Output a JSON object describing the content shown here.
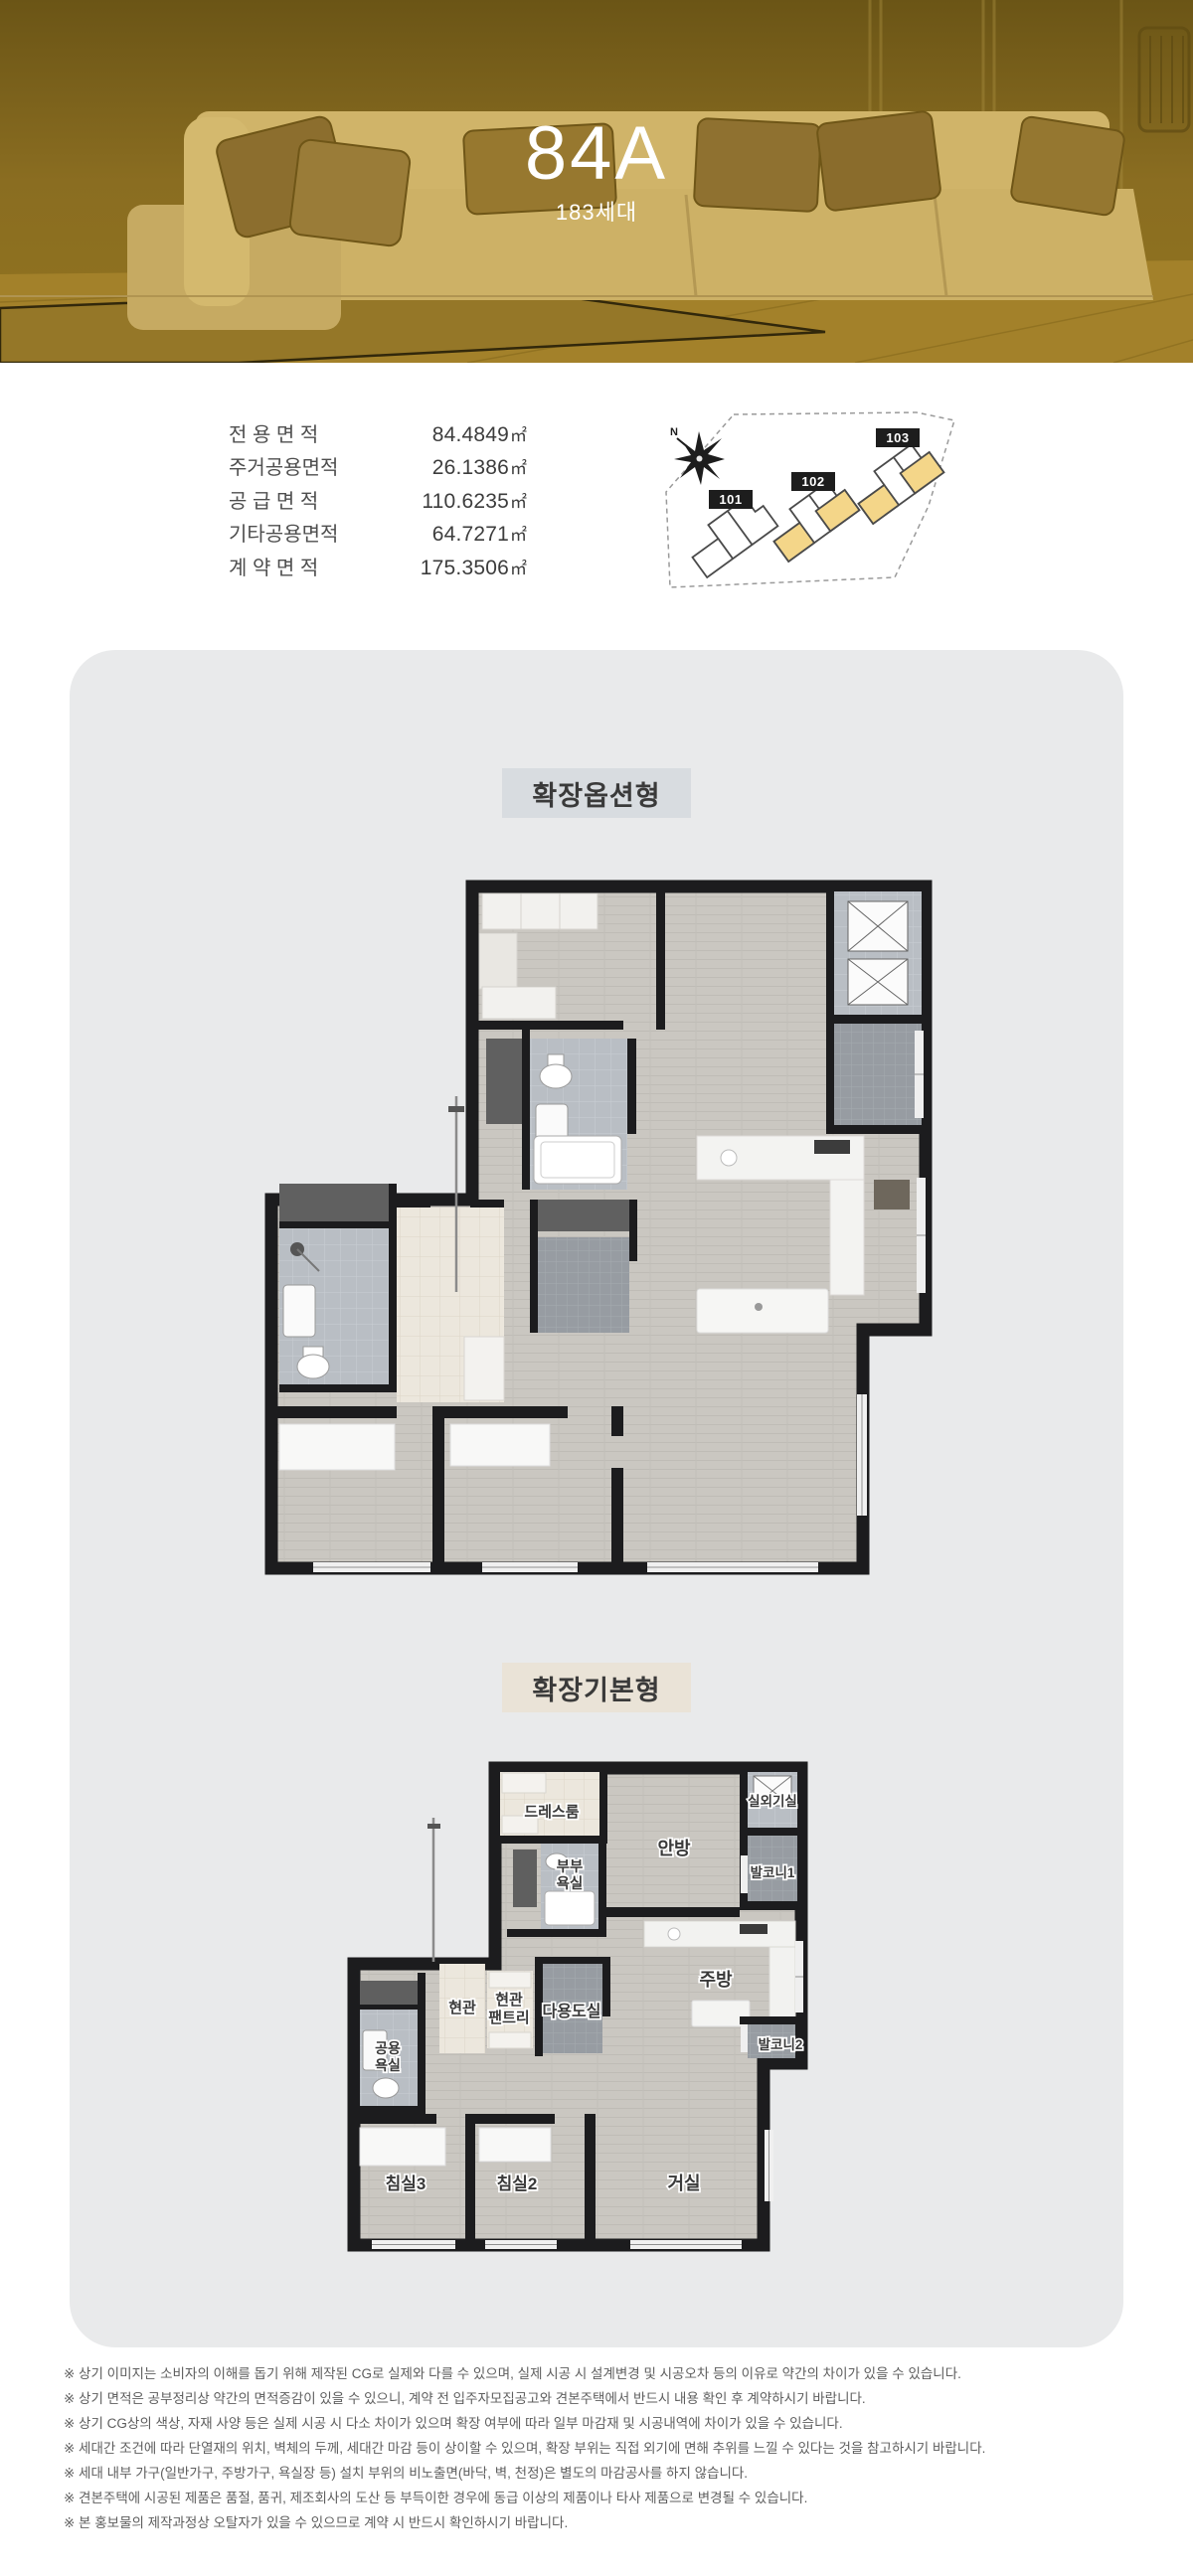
{
  "hero": {
    "title": "84A",
    "subtitle": "183세대"
  },
  "area_table": {
    "rows": [
      {
        "label": "전 용 면 적",
        "value": "84.4849",
        "unit": "㎡"
      },
      {
        "label": "주거공용면적",
        "value": "26.1386",
        "unit": "㎡"
      },
      {
        "label": "공 급 면 적",
        "value": "110.6235",
        "unit": "㎡"
      },
      {
        "label": "기타공용면적",
        "value": "64.7271",
        "unit": "㎡"
      },
      {
        "label": "계 약 면 적",
        "value": "175.3506",
        "unit": "㎡"
      }
    ]
  },
  "site_plan": {
    "north_label": "N",
    "highlight_color": "#f4d689",
    "buildings": [
      {
        "id": "101",
        "highlighted": false
      },
      {
        "id": "102",
        "highlighted": true
      },
      {
        "id": "103",
        "highlighted": true
      }
    ]
  },
  "sections": [
    {
      "label": "확장옵션형"
    },
    {
      "label": "확장기본형"
    }
  ],
  "rooms": {
    "dressroom": "드레스룸",
    "master": "안방",
    "outdoor_unit": "실외기실",
    "master_bath": {
      "line1": "부부",
      "line2": "욕실"
    },
    "balcony1": "발코니1",
    "kitchen": "주방",
    "entry": "현관",
    "entry_pantry": {
      "line1": "현관",
      "line2": "팬트리"
    },
    "utility": "다용도실",
    "balcony2": "발코니2",
    "common_bath": {
      "line1": "공용",
      "line2": "욕실"
    },
    "bedroom3": "침실3",
    "bedroom2": "침실2",
    "living": "거실"
  },
  "disclaimers": [
    "※ 상기 이미지는 소비자의 이해를 돕기 위해 제작된 CG로 실제와 다를 수 있으며, 실제 시공 시 설계변경 및 시공오차 등의 이유로 약간의 차이가 있을 수 있습니다.",
    "※ 상기 면적은 공부정리상 약간의 면적증감이 있을 수 있으니, 계약 전 입주자모집공고와 견본주택에서 반드시 내용 확인 후 계약하시기 바랍니다.",
    "※ 상기 CG상의 색상, 자재 사양 등은 실제 시공 시 다소 차이가 있으며 확장 여부에 따라 일부 마감재 및 시공내역에 차이가 있을 수 있습니다.",
    "※ 세대간 조건에 따라 단열재의 위치, 벽체의 두께, 세대간 마감 등이 상이할 수 있으며, 확장 부위는 직접 외기에 면해 추위를 느낄 수 있다는 것을 참고하시기 바랍니다.",
    "※ 세대 내부 가구(일반가구, 주방가구, 욕실장 등) 설치 부위의 비노출면(바닥, 벽, 천정)은 별도의 마감공사를 하지 않습니다.",
    "※ 견본주택에 시공된 제품은 품절, 품귀, 제조회사의 도산 등 부득이한 경우에 동급 이상의 제품이나 타사 제품으로 변경될 수 있습니다.",
    "※ 본 홍보물의 제작과정상 오탈자가 있을 수 있으므로 계약 시 반드시 확인하시기 바랍니다."
  ]
}
